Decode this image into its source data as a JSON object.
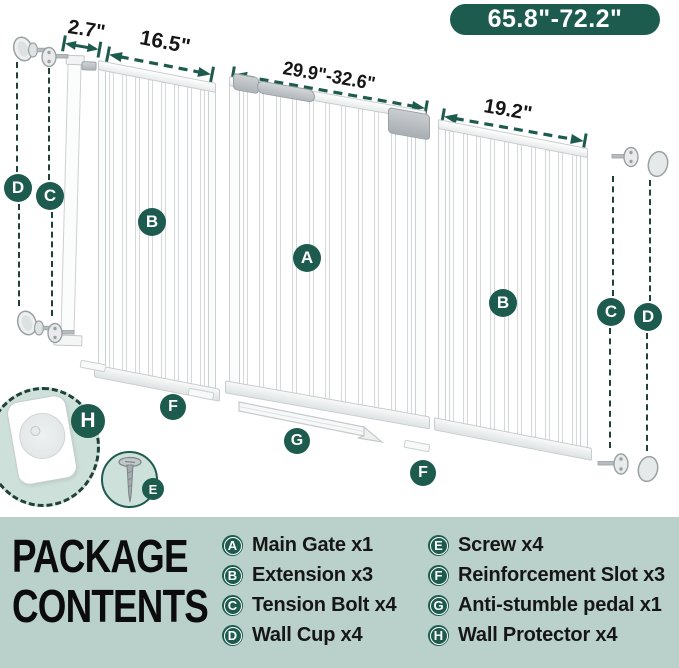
{
  "size_badge": "65.8\"-72.2\"",
  "measurements": {
    "small_ext": "2.7\"",
    "left_ext": "16.5\"",
    "main_gate": "29.9\"-32.6\"",
    "right_ext": "19.2\""
  },
  "badges": {
    "main_gate": "A",
    "extension": "B",
    "tension_bolt": "C",
    "wall_cup": "D",
    "screw": "E",
    "reinforcement_slot": "F",
    "pedal": "G",
    "wall_protector": "H"
  },
  "legend": {
    "title_line1": "PACKAGE",
    "title_line2": "CONTENTS",
    "items": [
      {
        "letter": "A",
        "label": "Main Gate x1"
      },
      {
        "letter": "B",
        "label": "Extension x3"
      },
      {
        "letter": "C",
        "label": "Tension Bolt x4"
      },
      {
        "letter": "D",
        "label": "Wall Cup x4"
      },
      {
        "letter": "E",
        "label": "Screw x4"
      },
      {
        "letter": "F",
        "label": "Reinforcement Slot x3"
      },
      {
        "letter": "G",
        "label": "Anti-stumble pedal x1"
      },
      {
        "letter": "H",
        "label": "Wall Protector x4"
      }
    ]
  },
  "colors": {
    "accent": "#1d5b4e",
    "panel_bg": "#b9d1ca",
    "circle_bg": "#cde0d9",
    "dash": "#20413a"
  }
}
